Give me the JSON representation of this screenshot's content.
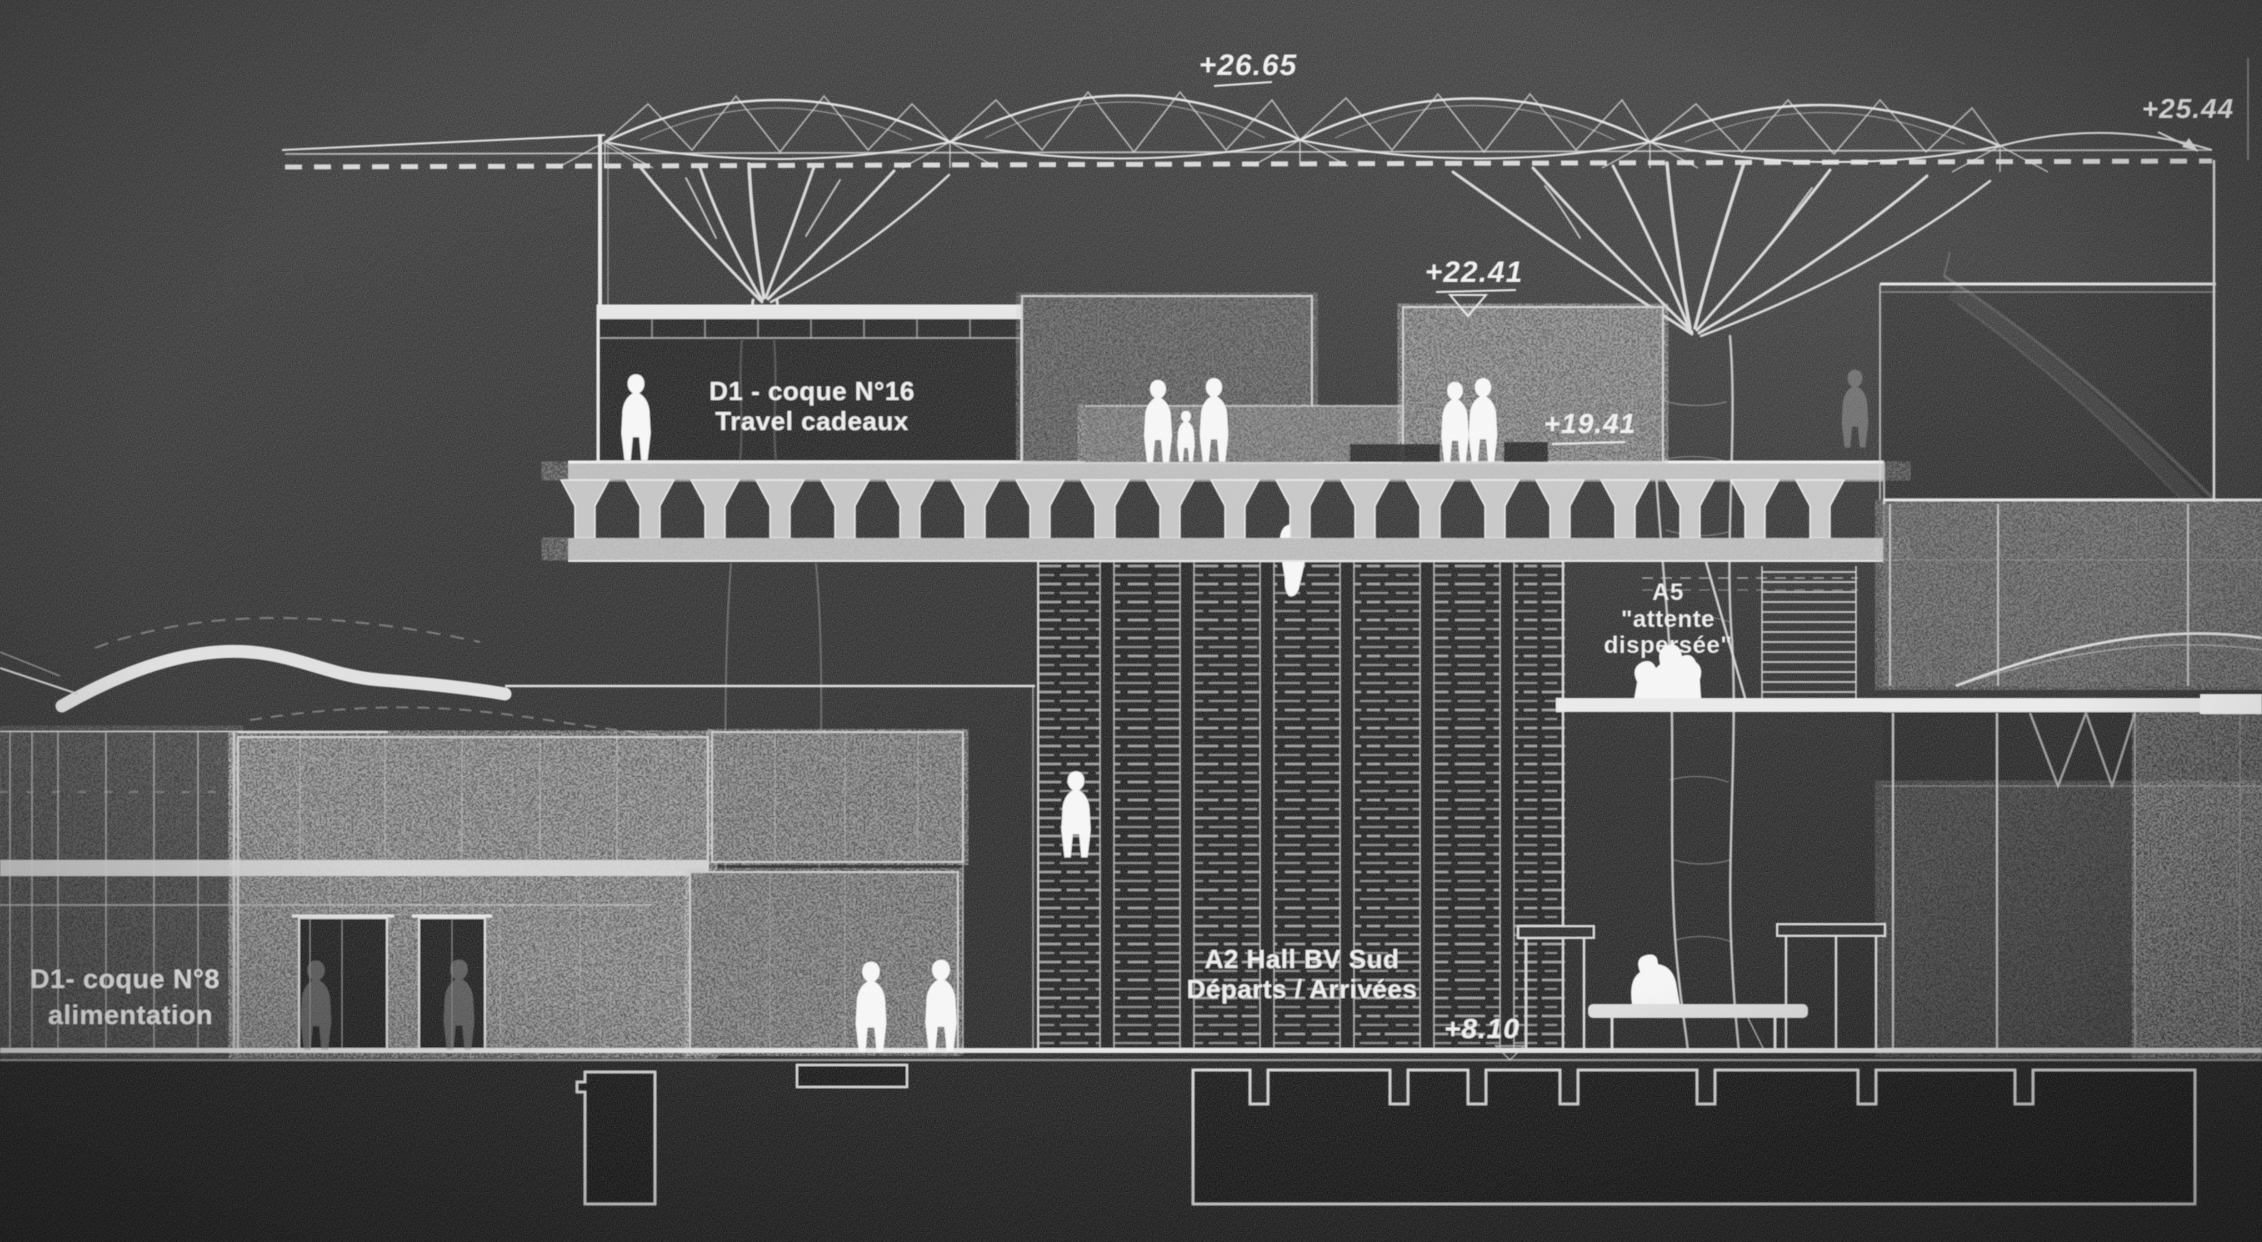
{
  "drawing": {
    "elevations": {
      "canopy_top": "+26.65",
      "roof_edge": "+25.44",
      "block_top": "+22.41",
      "platform_level": "+19.41",
      "ground_level": "+8.10"
    },
    "labels": {
      "shop16_line1": "D1 - coque N°16",
      "shop16_line2": "Travel cadeaux",
      "waiting_line1": "A5",
      "waiting_line2": "\"attente",
      "waiting_line3": "dispersée\"",
      "shop8_line1": "D1- coque N°8",
      "shop8_line2": "alimentation",
      "hall_line1": "A2 Hall BV Sud",
      "hall_line2": "Départs / Arrivées"
    }
  }
}
